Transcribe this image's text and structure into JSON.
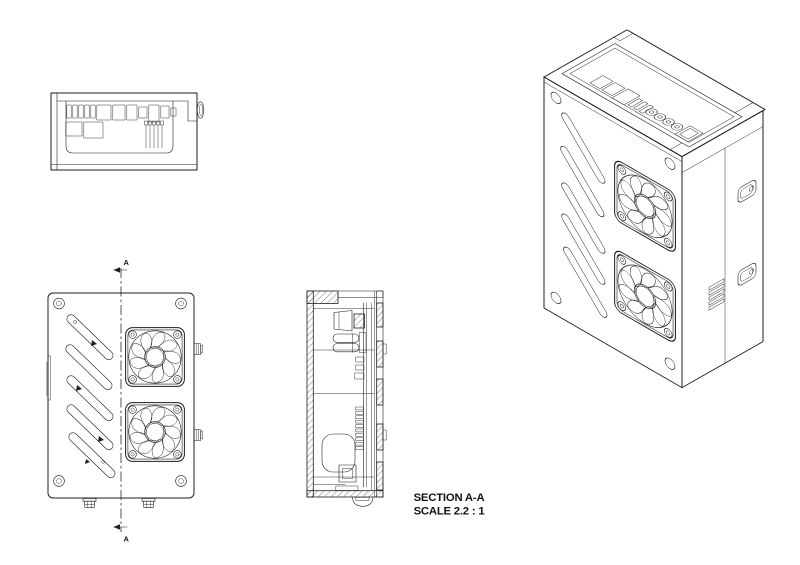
{
  "drawing": {
    "section_title": "SECTION A-A",
    "scale_note": "SCALE 2.2 : 1",
    "section_marker_top": "A",
    "section_marker_bottom": "A"
  },
  "colors": {
    "line": "#1f1f1f",
    "background": "#ffffff"
  }
}
